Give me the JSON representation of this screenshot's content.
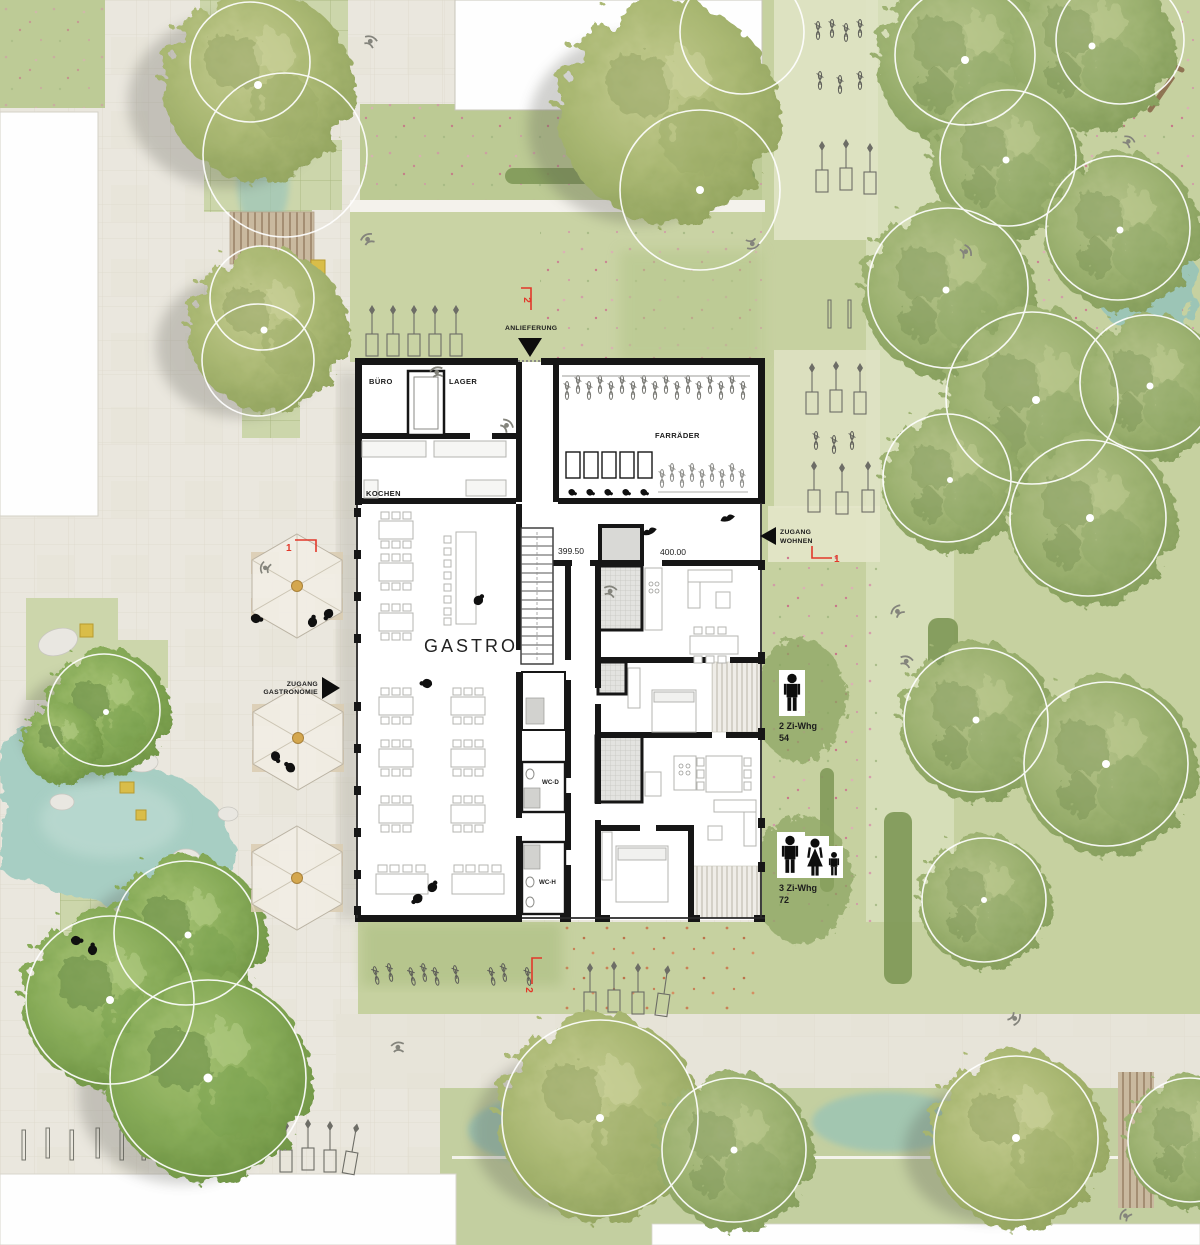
{
  "rooms": {
    "buero": "BÜRO",
    "lager": "LAGER",
    "kochen": "KOCHEN",
    "fahrraeder": "FARRÄDER",
    "gastro": "GASTRO",
    "wc_damen": "WC-D",
    "wc_herren": "WC-H"
  },
  "levels": {
    "gastro": "399.50",
    "wohnen": "400.00"
  },
  "entrances": {
    "anlieferung": "ANLIEFERUNG",
    "zugang_wohnen_line1": "ZUGANG",
    "zugang_wohnen_line2": "WOHNEN",
    "zugang_gastro_line1": "ZUGANG",
    "zugang_gastro_line2": "GASTRONOMIE"
  },
  "apartments": {
    "two_room": {
      "type": "2 Zi-Whg",
      "area": "54"
    },
    "three_room": {
      "type": "3 Zi-Whg",
      "area": "72"
    }
  },
  "section_markers": {
    "top": "2",
    "bottom": "2",
    "plaza": "1",
    "park": "1"
  },
  "colors": {
    "accent_red": "#e2382a",
    "wall": "#161616",
    "water": "#a7cec3",
    "lawn": "#c6d1a0",
    "pavement": "#eae7de",
    "canopy": "#9cb271",
    "bench_yellow": "#d9bd49"
  }
}
